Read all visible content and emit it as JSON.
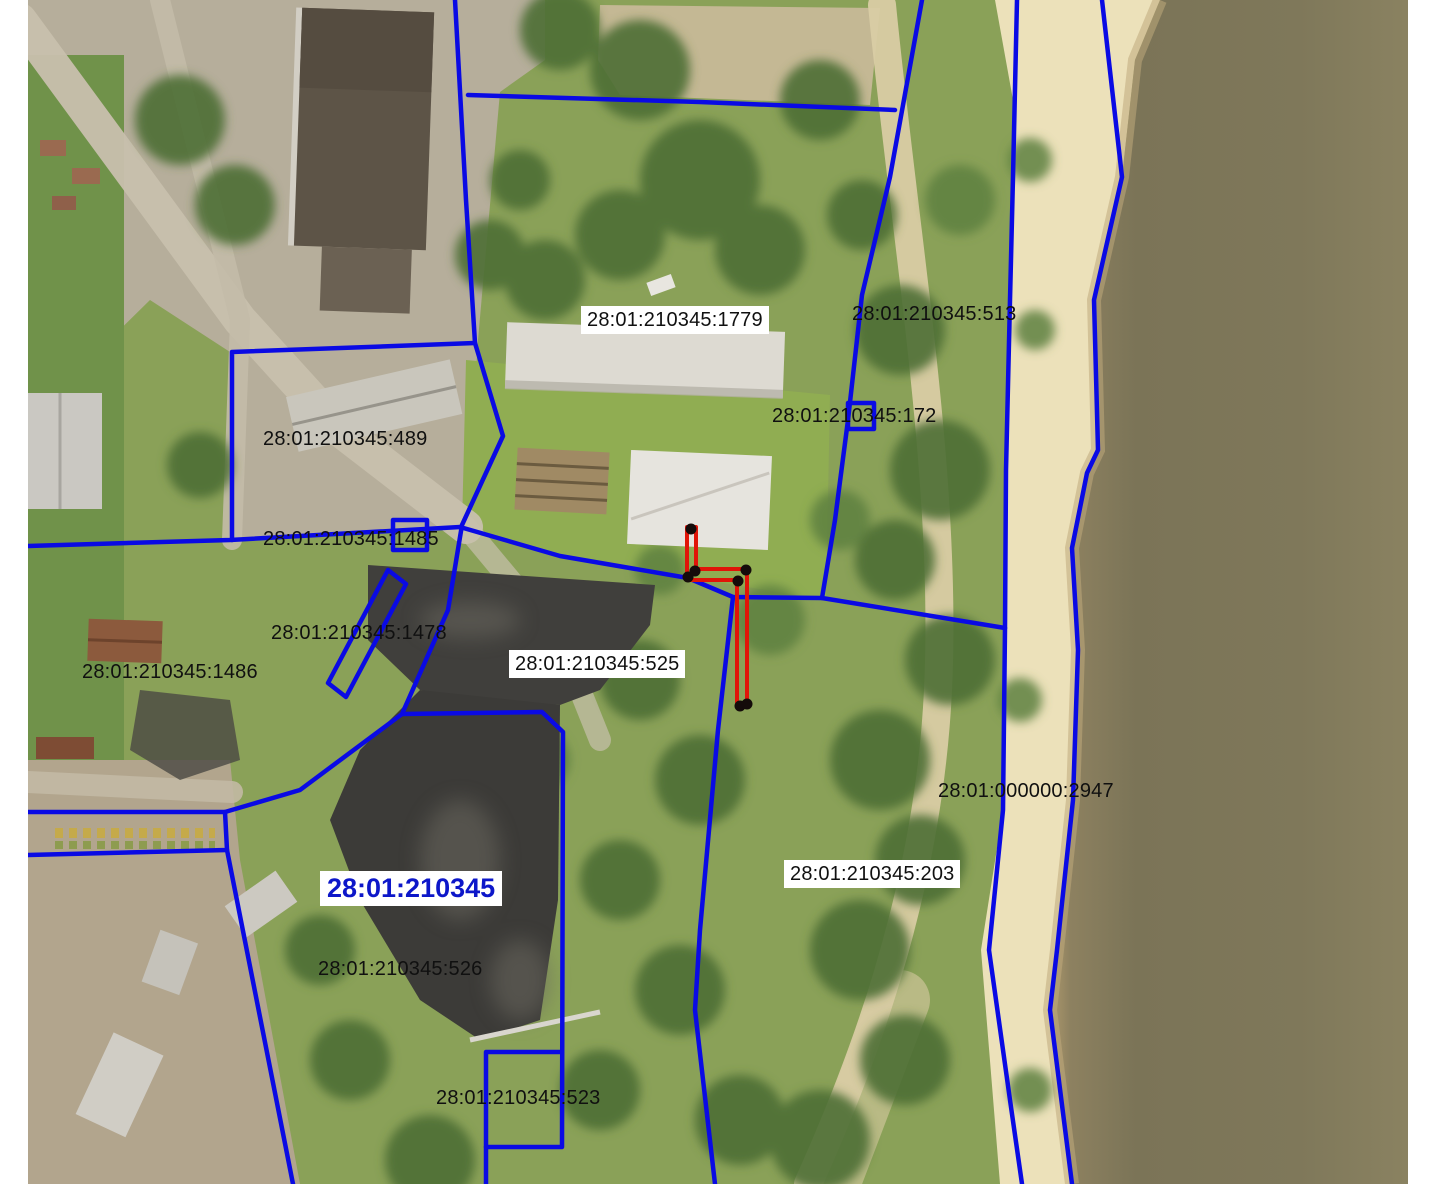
{
  "map": {
    "type": "cadastral-aerial-overlay",
    "quarter_label": {
      "text": "28:01:210345"
    },
    "parcel_labels": [
      {
        "text": "28:01:210345:1779",
        "bg": true
      },
      {
        "text": "28:01:210345:513",
        "bg": false
      },
      {
        "text": "28:01:210345:172",
        "bg": false
      },
      {
        "text": "28:01:210345:489",
        "bg": false
      },
      {
        "text": "28:01:210345:1485",
        "bg": false
      },
      {
        "text": "28:01:210345:1478",
        "bg": false
      },
      {
        "text": "28:01:210345:1486",
        "bg": false
      },
      {
        "text": "28:01:210345:525",
        "bg": true
      },
      {
        "text": "28:01:000000:2947",
        "bg": false
      },
      {
        "text": "28:01:210345:203",
        "bg": true
      },
      {
        "text": "28:01:210345:526",
        "bg": false
      },
      {
        "text": "28:01:210345:523",
        "bg": false
      }
    ],
    "selection": {
      "outline": "687,527 696,527 696,569 747,569 747,707 737,707 737,580 687,580",
      "vertices": [
        [
          691,
          529
        ],
        [
          688,
          577
        ],
        [
          695,
          571
        ],
        [
          746,
          570
        ],
        [
          738,
          581
        ],
        [
          740,
          706
        ],
        [
          747,
          704
        ]
      ]
    },
    "colors": {
      "parcel_line": "#0a0ae4",
      "selection": "#e11408",
      "vertex": "#140b0a",
      "label_text": "#101010",
      "quarter_label": "#0d17c9",
      "water": "#7e7659",
      "sand": "#ece1ba",
      "vegetation": "#8aa158"
    }
  }
}
